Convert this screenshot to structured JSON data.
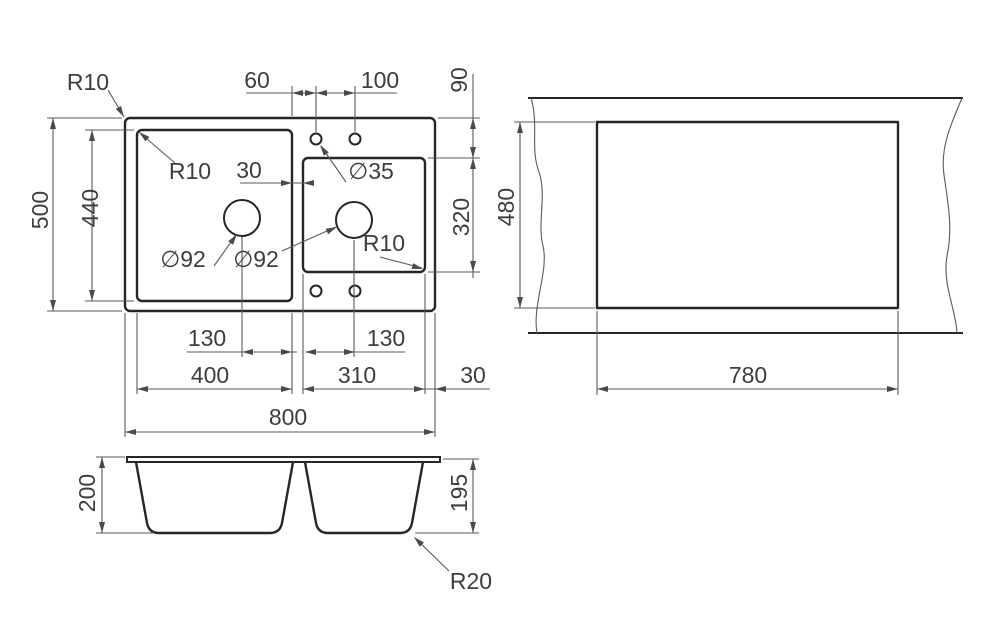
{
  "drawing_title": "double-bowl sink dimension drawing",
  "plan": {
    "radius_outer_label": "R10",
    "hole_offset_60": "60",
    "hole_spacing_100": "100",
    "edge_offset_90": "90",
    "overall_depth_500": "500",
    "left_bowl_depth_440": "440",
    "radius_left_bowl_label": "R10",
    "divider_width_30": "30",
    "faucet_hole_dia": "∅35",
    "drain_dia_left": "∅92",
    "drain_dia_right": "∅92",
    "radius_right_bowl_label": "R10",
    "right_bowl_depth_320": "320",
    "drain_offset_left_130": "130",
    "drain_offset_right_130": "130",
    "left_bowl_width_400": "400",
    "right_bowl_width_310": "310",
    "edge_margin_30": "30",
    "overall_width_800": "800"
  },
  "cutout": {
    "cutout_depth_480": "480",
    "cutout_width_780": "780"
  },
  "section": {
    "total_depth_200": "200",
    "bowl_depth_195": "195",
    "bottom_radius_label": "R20"
  }
}
